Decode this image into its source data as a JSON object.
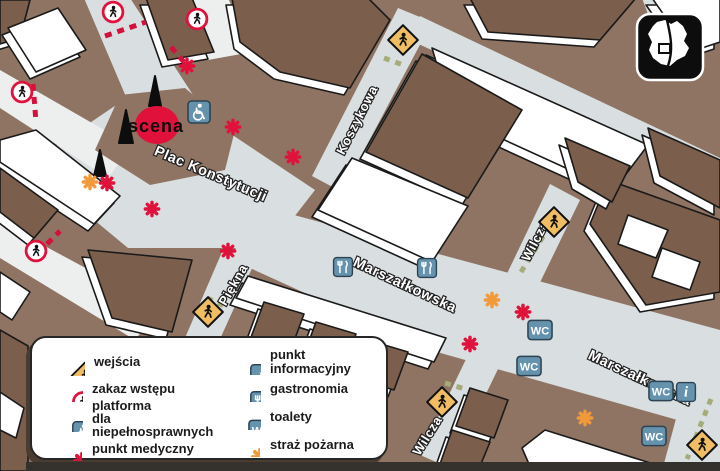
{
  "map": {
    "stage_label": "scena",
    "labels": {
      "plac_konstytucji": "Plac Konstytucji",
      "marszalkowska": "Marszałkowska",
      "koszykowa": "Koszykowa",
      "piekna": "Piękna",
      "wilcza": "Wilcza"
    },
    "icon_glyphs": {
      "wc": "WC",
      "info": "i"
    },
    "markers": {
      "entrance": [
        [
          403,
          40
        ],
        [
          554,
          222
        ],
        [
          208,
          312
        ],
        [
          442,
          402
        ],
        [
          702,
          445
        ]
      ],
      "no_entry": [
        [
          113,
          12
        ],
        [
          197,
          19
        ],
        [
          22,
          92
        ],
        [
          36,
          251
        ]
      ],
      "wheelchair_platform": [
        [
          199,
          112
        ]
      ],
      "medical": [
        [
          187,
          66
        ],
        [
          233,
          127
        ],
        [
          293,
          157
        ],
        [
          107,
          183
        ],
        [
          152,
          209
        ],
        [
          228,
          251
        ],
        [
          523,
          312
        ],
        [
          470,
          344
        ]
      ],
      "fire_brigade": [
        [
          90,
          182
        ],
        [
          492,
          300
        ],
        [
          585,
          418
        ]
      ],
      "food": [
        [
          343,
          267
        ],
        [
          427,
          268
        ]
      ],
      "toilets": [
        [
          540,
          330
        ],
        [
          529,
          366
        ],
        [
          661,
          391
        ],
        [
          654,
          436
        ]
      ],
      "info": [
        [
          686,
          392
        ]
      ]
    },
    "minimap": {
      "name": "warsaw-overview"
    }
  },
  "legend": {
    "items": [
      {
        "icon": "entrance",
        "label": "wejścia"
      },
      {
        "icon": "no-entry",
        "label": "zakaz wstępu"
      },
      {
        "icon": "wheelchair",
        "label": "platforma\ndla niepełnosprawnych"
      },
      {
        "icon": "medical",
        "label": "punkt medyczny"
      },
      {
        "icon": "info",
        "label": "punkt informacyjny"
      },
      {
        "icon": "food",
        "label": "gastronomia"
      },
      {
        "icon": "toilets",
        "label": "toalety"
      },
      {
        "icon": "fire",
        "label": "straż pożarna"
      }
    ]
  },
  "colors": {
    "street": "#d9dfe1",
    "ground": "#8f7463",
    "roof_dark": "#7b5e4c",
    "accent_red": "#e0123c",
    "accent_orange": "#f09a3a",
    "icon_blue": "#6592ad",
    "entrance_yellow": "#f0bd62",
    "barrier_red_dash": "#d4103c",
    "barrier_green_dash": "#a6ab7a"
  }
}
